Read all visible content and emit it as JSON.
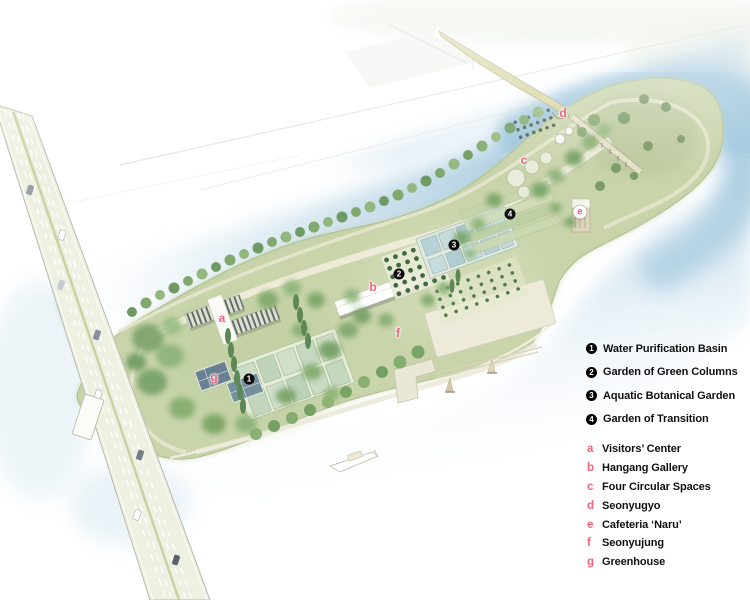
{
  "map": {
    "subject": "Seonyudo island park bird's-eye illustration",
    "legend": {
      "numbered": [
        {
          "num": "1",
          "label": "Water Purification Basin"
        },
        {
          "num": "2",
          "label": "Garden of Green Columns"
        },
        {
          "num": "3",
          "label": "Aquatic Botanical Garden"
        },
        {
          "num": "4",
          "label": "Garden of Transition"
        }
      ],
      "lettered": [
        {
          "key": "a",
          "label": "Visitors’ Center"
        },
        {
          "key": "b",
          "label": "Hangang Gallery"
        },
        {
          "key": "c",
          "label": "Four Circular Spaces"
        },
        {
          "key": "d",
          "label": "Seonyugyo"
        },
        {
          "key": "e",
          "label": "Cafeteria ‘Naru’"
        },
        {
          "key": "f",
          "label": "Seonyujung"
        },
        {
          "key": "g",
          "label": "Greenhouse"
        }
      ]
    },
    "map_markers": [
      {
        "id": "1",
        "style": "number",
        "label": "1",
        "x": 249,
        "y": 379
      },
      {
        "id": "2",
        "style": "number",
        "label": "2",
        "x": 399,
        "y": 274
      },
      {
        "id": "3",
        "style": "number",
        "label": "3",
        "x": 454,
        "y": 245
      },
      {
        "id": "4",
        "style": "number",
        "label": "4",
        "x": 510,
        "y": 214
      },
      {
        "id": "a",
        "style": "letter",
        "label": "a",
        "x": 222,
        "y": 318
      },
      {
        "id": "b",
        "style": "letter",
        "label": "b",
        "x": 373,
        "y": 287
      },
      {
        "id": "c",
        "style": "letter",
        "label": "c",
        "x": 524,
        "y": 160
      },
      {
        "id": "d",
        "style": "letter",
        "label": "d",
        "x": 563,
        "y": 113
      },
      {
        "id": "e",
        "style": "letter-badge",
        "label": "e",
        "x": 580,
        "y": 212
      },
      {
        "id": "f",
        "style": "letter",
        "label": "f",
        "x": 398,
        "y": 333
      },
      {
        "id": "g",
        "style": "letter",
        "label": "g",
        "x": 214,
        "y": 377
      }
    ],
    "colors": {
      "accent_pink": "#f2637a",
      "marker_black": "#0c0c0c",
      "water_blue": "#aecfe2",
      "island_green": "#c9d4ab",
      "path_cream": "#edead8",
      "road_surface": "#eef0e1",
      "footbridge_deck": "#d8d5a2",
      "greenhouse_slate": "#6d8492"
    }
  }
}
